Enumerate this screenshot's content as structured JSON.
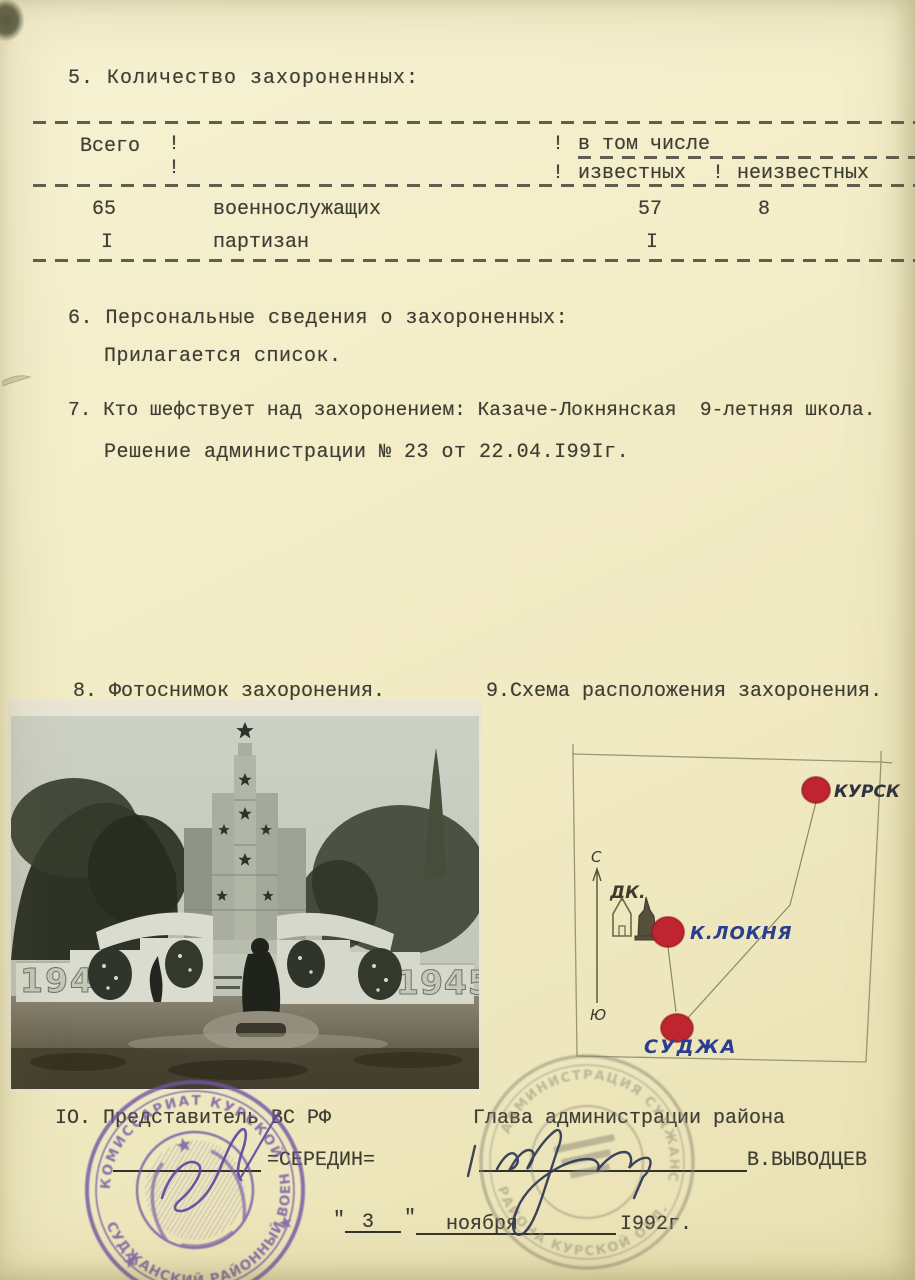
{
  "section5": {
    "heading": "5. Количество захороненных:",
    "table": {
      "sep": "!",
      "col_total": "Всего",
      "col_incl": "в том числе",
      "col_known": "известных",
      "col_unknown": "неизвестных",
      "rows": [
        {
          "total": "65",
          "category": "военнослужащих",
          "known": "57",
          "unknown": "8"
        },
        {
          "total": "I",
          "category": "партизан",
          "known": "I",
          "unknown": ""
        }
      ]
    }
  },
  "section6": {
    "line1": "6. Персональные сведения о захороненных:",
    "line2": "Прилагается список."
  },
  "section7": {
    "line1": "7. Кто шефствует над захоронением: Казаче-Локнянская  9-летняя школа.",
    "line2": "Решение администрации № 23 от 22.04.I99Iг."
  },
  "section8": {
    "heading": "8. Фотоснимок захоронения.",
    "photo": {
      "year_left": "1941",
      "year_right": "1945"
    }
  },
  "section9": {
    "heading": "9.Схема расположения захоронения.",
    "map": {
      "compass_north": "С",
      "compass_south": "Ю",
      "dk_label": "ДК.",
      "points": [
        {
          "label": "КУРСК"
        },
        {
          "label": "К.ЛОКНЯ"
        },
        {
          "label": "СУДЖА"
        }
      ],
      "dot_color": "#c0242e",
      "ink_color": "#2b3d8f"
    }
  },
  "section10": {
    "left_title": "IО. Представитель ВС РФ",
    "left_name": "=СЕРЕДИН=",
    "right_title": "Глава администрации района",
    "right_name": "В.ВЫВОДЦЕВ",
    "date": {
      "q1": "\"",
      "day": "3",
      "q2": "\"",
      "month": "ноября",
      "year": "I992г."
    },
    "stamps": {
      "left": {
        "arc_top": "КОМИССАРИАТ  КУРСКОЙ ОБЛ.",
        "arc_bottom": "СУДЖАНСКИЙ РАЙОННЫЙ ВОЕННЫЙ",
        "color": "#6f55a4"
      },
      "right": {
        "arc_top": "АДМИНИСТРАЦИЯ СУДЖАНСКОГО",
        "arc_bottom": "РАЙОНА КУРСКОЙ ОБЛ.",
        "color": "#8b8574"
      }
    }
  }
}
